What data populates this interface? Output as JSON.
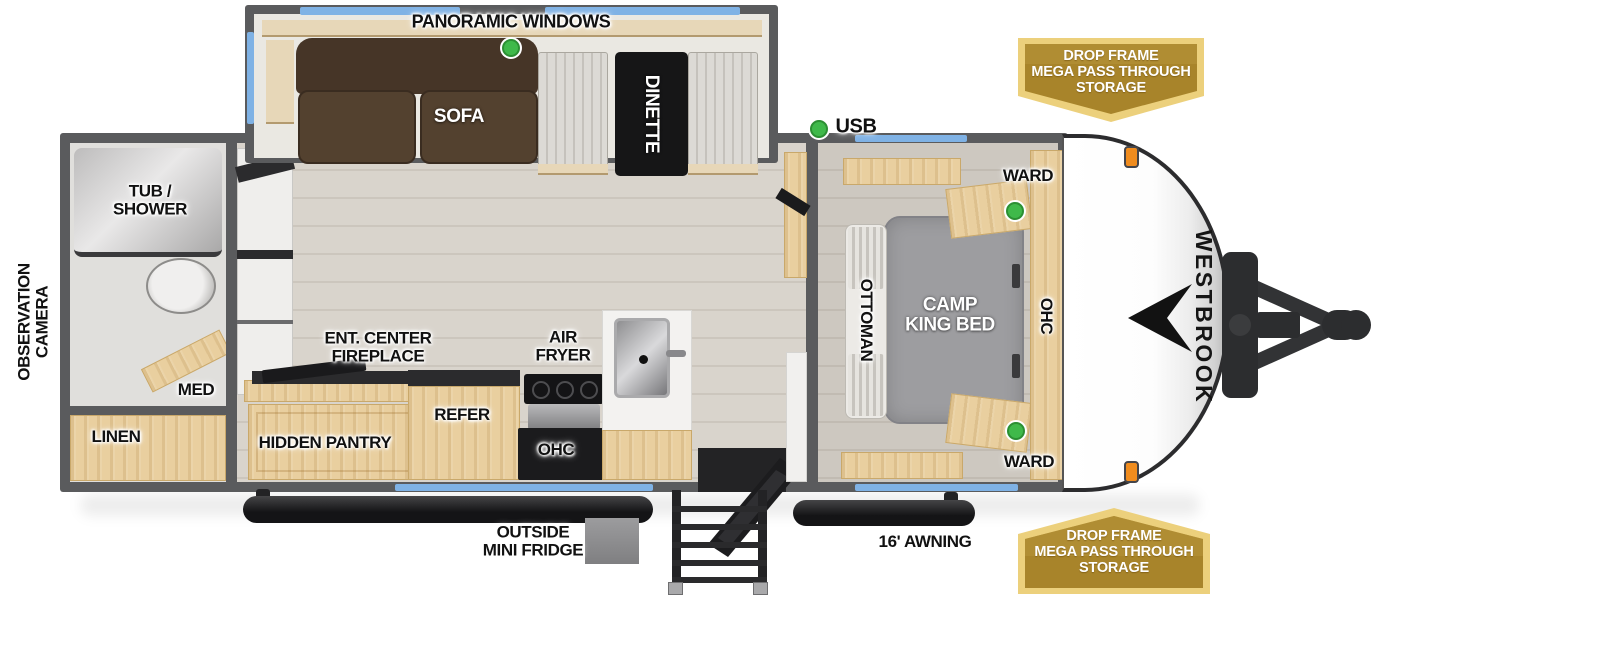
{
  "brand": "WESTBROOK",
  "labels": {
    "panoramic_windows": "PANORAMIC WINDOWS",
    "sofa": "SOFA",
    "dinette": "DINETTE",
    "usb": "USB",
    "ward_top": "WARD",
    "ward_bottom": "WARD",
    "camp_king_bed": "CAMP\nKING BED",
    "ottoman": "OTTOMAN",
    "ohc_bedroom": "OHC",
    "tub_shower": "TUB /\nSHOWER",
    "observation_camera": "OBSERVATION\nCAMERA",
    "med": "MED",
    "linen": "LINEN",
    "ent_center_fireplace": "ENT. CENTER\nFIREPLACE",
    "hidden_pantry": "HIDDEN PANTRY",
    "refer": "REFER",
    "air_fryer": "AIR\nFRYER",
    "ohc_kitchen": "OHC",
    "outside_mini_fridge": "OUTSIDE\nMINI FRIDGE",
    "awning": "16' AWNING"
  },
  "badges": {
    "storage_top": {
      "lines": [
        "DROP FRAME",
        "MEGA PASS THROUGH",
        "STORAGE"
      ]
    },
    "storage_bottom": {
      "lines": [
        "DROP FRAME",
        "MEGA PASS THROUGH",
        "STORAGE"
      ]
    }
  },
  "indicators": {
    "led_color": "#3fb94a",
    "count": 4
  },
  "colors": {
    "wall": "#5a5b5d",
    "window_blue": "#7fb2e5",
    "wood": "#e9cf9f",
    "badge_gold_fill": "#a8842a",
    "badge_gold_border": "#ecd07c",
    "awning_black": "#1d1d1f",
    "floor": "#d9d4cc",
    "accent_orange": "#f08c1e"
  }
}
